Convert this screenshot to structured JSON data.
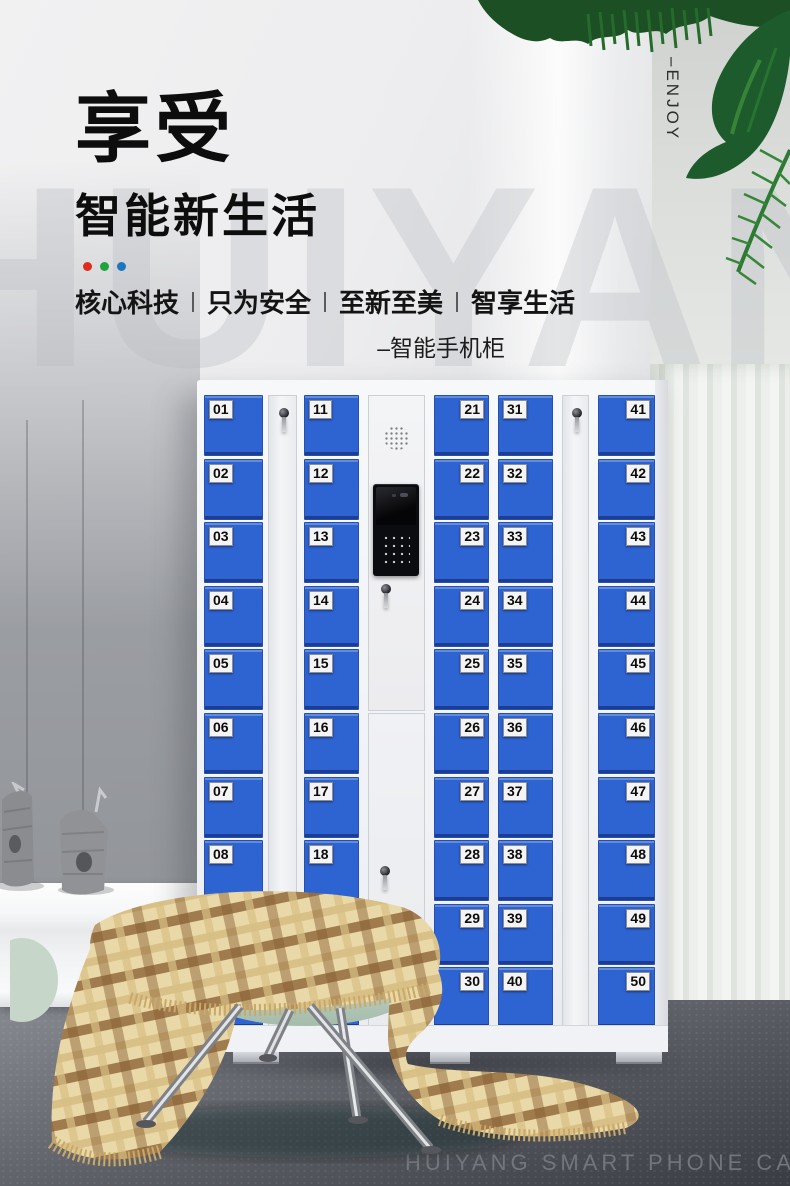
{
  "hero": {
    "title": "享受",
    "subtitle": "智能新生活",
    "dots": [
      "#e02b1d",
      "#1fa33c",
      "#1a77c2"
    ],
    "tagline": [
      "核心科技",
      "只为安全",
      "至新至美",
      "智享生活"
    ],
    "product_caption": "–智能手机柜"
  },
  "vertical_label": "–ENJOY",
  "watermark": "HUIYANG",
  "floor_caption": "HUIYANG SMART PHONE CABINET",
  "cabinet": {
    "door_color": "#2e63d2",
    "columns": [
      {
        "name": "locker-column-01-10",
        "type": "lockers",
        "label_side": "left",
        "numbers": [
          "01",
          "02",
          "03",
          "04",
          "05",
          "06",
          "07",
          "08",
          "09",
          "10"
        ]
      },
      {
        "name": "side-lock-column-left",
        "type": "side"
      },
      {
        "name": "locker-column-11-20",
        "type": "lockers",
        "label_side": "left",
        "numbers": [
          "11",
          "12",
          "13",
          "14",
          "15",
          "16",
          "17",
          "18",
          "19",
          "20"
        ]
      },
      {
        "name": "control-column",
        "type": "control"
      },
      {
        "name": "locker-column-21-30",
        "type": "lockers",
        "label_side": "right",
        "numbers": [
          "21",
          "22",
          "23",
          "24",
          "25",
          "26",
          "27",
          "28",
          "29",
          "30"
        ]
      },
      {
        "name": "locker-column-31-40",
        "type": "lockers",
        "label_side": "left",
        "numbers": [
          "31",
          "32",
          "33",
          "34",
          "35",
          "36",
          "37",
          "38",
          "39",
          "40"
        ]
      },
      {
        "name": "side-lock-column-right",
        "type": "side"
      },
      {
        "name": "locker-column-41-50",
        "type": "lockers",
        "label_side": "right",
        "numbers": [
          "41",
          "42",
          "43",
          "44",
          "45",
          "46",
          "47",
          "48",
          "49",
          "50"
        ]
      }
    ]
  }
}
